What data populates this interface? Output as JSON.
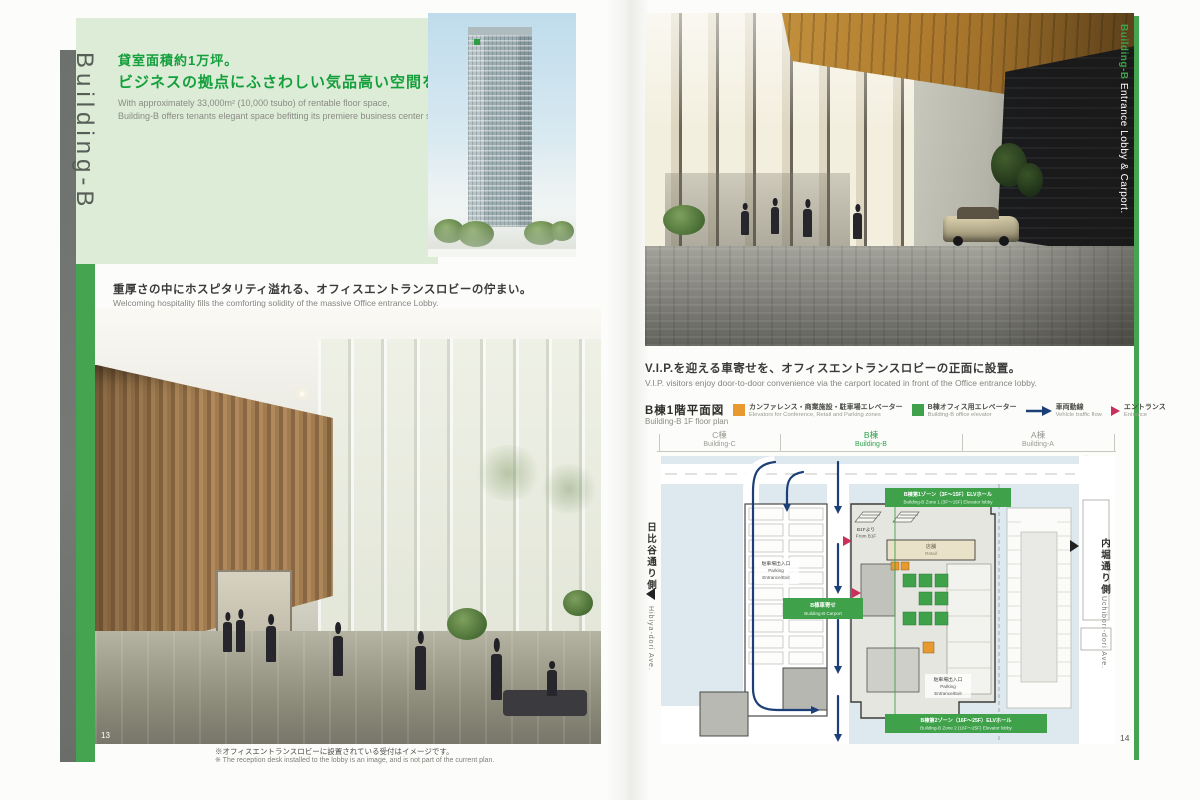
{
  "colors": {
    "accent_green": "#3fa14a",
    "panel_green": "#dcecd6",
    "heading_green": "#149f3c",
    "plan_background": "#dde8ef",
    "vehicle_flow_navy": "#1c3f77",
    "entrance_red": "#c9305a",
    "legend_orange": "#e8992f",
    "retail_tan": "#eae2c8"
  },
  "left_page": {
    "page_number": "13",
    "sidebar_label": "Building-B",
    "header": {
      "title_jp_1": "貸室面積約1万坪。",
      "title_jp_2": "ビジネスの拠点にふさわしい気品高い空間を演出。",
      "subtitle_en_1": "With approximately 33,000m² (10,000 tsubo) of rentable floor space,",
      "subtitle_en_2": "Building-B offers tenants elegant space befitting its premiere business center status."
    },
    "lobby_heading_jp": "重厚さの中にホスピタリティ溢れる、オフィスエントランスロビーの佇まい。",
    "lobby_heading_en": "Welcoming hospitality fills the comforting solidity of the massive Office entrance Lobby.",
    "photo_note_jp": "※オフィスエントランスロビーに設置されている受付はイメージです。",
    "photo_note_en": "※ The reception desk installed to the lobby is an image, and is not part of the current plan."
  },
  "right_page": {
    "page_number": "14",
    "photo_edge_label_1": "Building-B",
    "photo_edge_label_2": " Entrance Lobby & Carport.",
    "carport_heading_jp": "V.I.P.を迎える車寄せを、オフィスエントランスロビーの正面に設置。",
    "carport_heading_en": "V.I.P. visitors enjoy door-to-door convenience via the carport located in front of the Office entrance lobby.",
    "plan": {
      "title_jp": "B棟1階平面図",
      "title_en": "Building-B 1F floor plan",
      "legend": [
        {
          "icon": "orange-square",
          "jp": "カンファレンス・商業施設・駐車場エレベーター",
          "en": "Elevators for Conference, Retail and Parking zones"
        },
        {
          "icon": "green-square",
          "jp": "B棟オフィス用エレベーター",
          "en": "Building-B office elevator"
        },
        {
          "icon": "blue-arrow",
          "jp": "車両動線",
          "en": "Vehicle traffic flow"
        },
        {
          "icon": "red-triangle",
          "jp": "エントランス",
          "en": "Entrance"
        }
      ],
      "building_headers": [
        {
          "jp": "C棟",
          "en": "Building-C"
        },
        {
          "jp": "B棟",
          "en": "Building-B"
        },
        {
          "jp": "A棟",
          "en": "Building-A"
        }
      ],
      "labels": {
        "zone1_jp": "B棟第1ゾーン（3F～15F）ELVホール",
        "zone1_en": "Building-B Zone 1 (3F～15F) Elevator lobby",
        "carport_jp": "B棟車寄せ",
        "carport_en": "Building-B Carport",
        "zone2_jp": "B棟第2ゾーン（16F～25F）ELVホール",
        "zone2_en": "Building-B Zone 2 (16F～25F) Elevator lobby",
        "from_b1f_jp": "B1Fより",
        "from_b1f_en": "From B1F",
        "retail_jp": "店舗",
        "retail_en": "Retail",
        "parking_jp": "駐車場出入口",
        "parking_en_1": "Parking",
        "parking_en_2": "Entrance/Exit"
      },
      "street_left_jp": "日比谷通り側",
      "street_left_en": "Hibiya-dori Ave.",
      "street_right_jp": "内堀通り側",
      "street_right_en": "Uchibori-dori Ave."
    }
  }
}
